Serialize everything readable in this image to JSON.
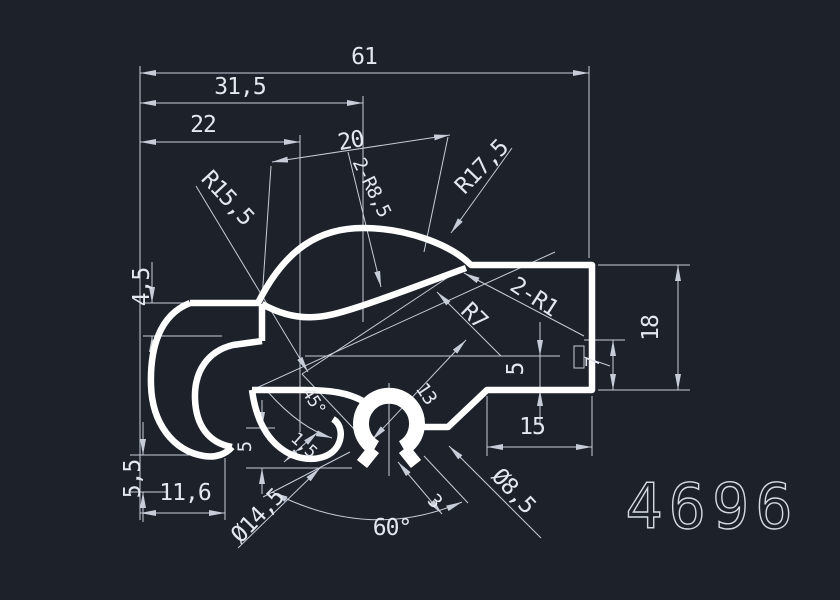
{
  "canvas": {
    "background": "#1c212a",
    "profile_color": "#ffffff",
    "dimension_color": "#c7cdd8",
    "text_color": "#e3e7ee"
  },
  "drawing_number": "4696",
  "labels": {
    "total_width": "61",
    "upper_width": "31,5",
    "left_width": "22",
    "aligned_width": "20",
    "arc_radius_pair": "2-R8,5",
    "top_radius": "R17,5",
    "left_radius": "R15,5",
    "left_top_height": "4,5",
    "fillet_pair": "2-R1",
    "right_height": "18",
    "step_height": "7",
    "inner_radius": "R7",
    "groove_depth": "5",
    "slot_length": "13",
    "tongue_length": "15",
    "left_bottom_height": "5,5",
    "bottom_width": "11,6",
    "lip_height": "5",
    "chamfer_angle": "45°",
    "chamfer_size": "1,5",
    "opening_angle": "60°",
    "slot_width": "3",
    "outer_diameter": "Ø14,5",
    "inner_diameter": "Ø8,5"
  }
}
